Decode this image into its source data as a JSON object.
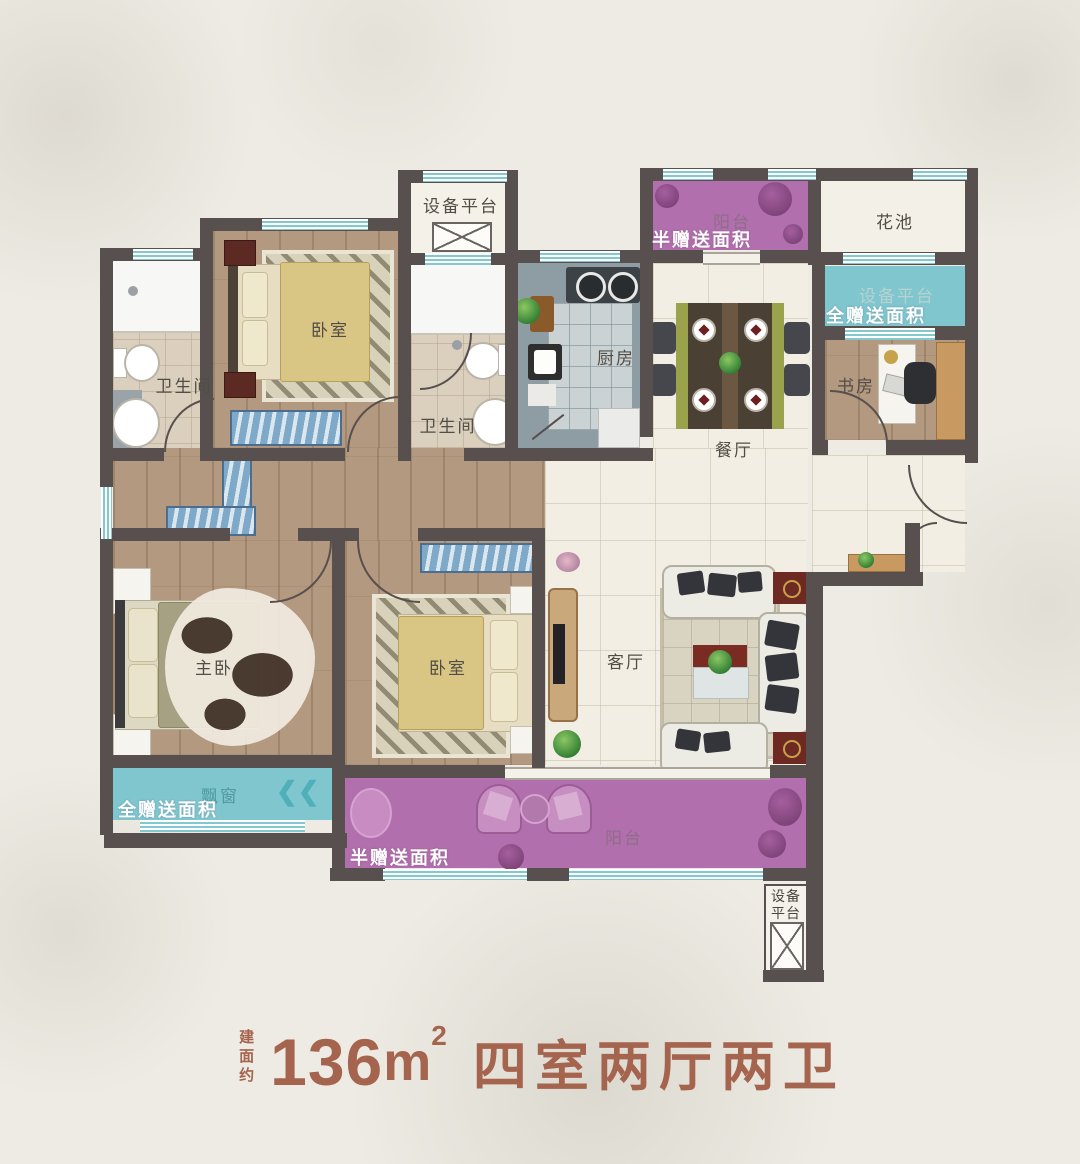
{
  "title": {
    "prefix_vertical": "建面约",
    "area_value": "136",
    "area_unit": "m",
    "area_sup": "2",
    "layout_name": "四室两厅两卫"
  },
  "rooms": {
    "equip_top": "设备平台",
    "bedroom_top": "卧室",
    "bath_left": "卫生间",
    "bath_mid": "卫生间",
    "kitchen": "厨房",
    "dining": "餐厅",
    "balcony_top": "阳台",
    "flower_bed": "花池",
    "equip_right": "设备平台",
    "study": "书房",
    "master": "主卧",
    "bedroom_mid": "卧室",
    "living": "客厅",
    "bay_window": "飘窗",
    "balcony_bottom": "阳台",
    "equip_bottom": "设备平台"
  },
  "bonus_labels": {
    "balcony_top": "半赠送面积",
    "equip_right": "全赠送面积",
    "bay_window": "全赠送面积",
    "balcony_bottom": "半赠送面积"
  },
  "decor": {
    "bay_chevrons": "❮❮"
  },
  "colors": {
    "wall": "#57504e",
    "balcony_purple": "#b26fad",
    "bonus_teal": "#7fc6cf",
    "wood_floor": "#b2997f",
    "tile_cream": "#f2eee3",
    "window_teal": "#82c8cf",
    "title_text": "#a5644e",
    "label_text": "#524d46"
  }
}
